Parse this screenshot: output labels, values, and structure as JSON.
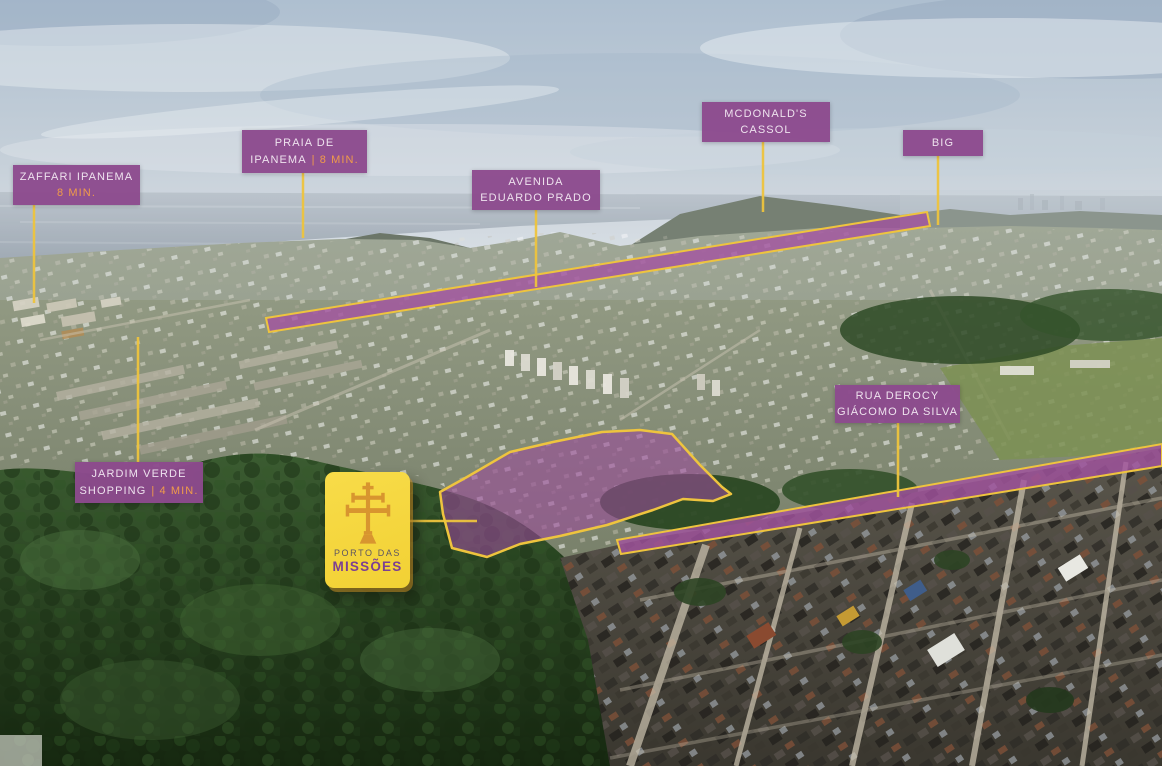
{
  "labels": {
    "zaffari": {
      "line1": "ZAFFARI IPANEMA",
      "line2": "",
      "time": "8 MIN."
    },
    "praia": {
      "line1": "PRAIA DE",
      "line2": "IPANEMA",
      "time": "| 8 MIN."
    },
    "avenida": {
      "line1": "AVENIDA",
      "line2": "EDUARDO PRADO",
      "time": ""
    },
    "mcdonalds": {
      "line1": "MCDONALD'S",
      "line2": "CASSOL",
      "time": ""
    },
    "big": {
      "line1": "BIG",
      "line2": "",
      "time": ""
    },
    "rua_derocy": {
      "line1": "RUA DEROCY",
      "line2": "GIÁCOMO DA SILVA",
      "time": ""
    },
    "jardim": {
      "line1": "JARDIM VERDE",
      "line2": "SHOPPING",
      "time": "| 4 MIN."
    }
  },
  "logo": {
    "top_line": "PORTO DAS",
    "name": "MISSÕES",
    "icon": "caravaca-cross-icon"
  },
  "colors": {
    "label_purple": "#8c4a8e",
    "highlight_purple": "#a050a0",
    "outline_yellow": "#eec43e",
    "time_orange": "#f09b4a",
    "logo_yellow": "#f5d640",
    "logo_purple": "#7c3f93",
    "logo_cross_orange": "#d8952f"
  }
}
